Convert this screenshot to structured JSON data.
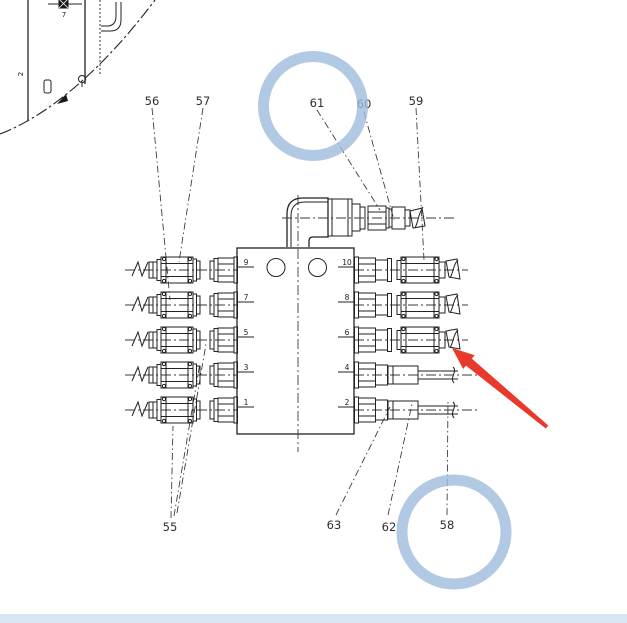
{
  "callouts": {
    "n55": "55",
    "n56": "56",
    "n57": "57",
    "n58": "58",
    "n59": "59",
    "n60": "60",
    "n61": "61",
    "n62": "62",
    "n63": "63"
  },
  "ports": {
    "left": [
      "9",
      "7",
      "5",
      "3",
      "1"
    ],
    "right": [
      "10",
      "8",
      "6",
      "4",
      "2"
    ]
  },
  "fragment": {
    "edge_mark": "2",
    "bolt_mark": "7"
  },
  "annotations": {
    "highlight_color": "#9dbbdc",
    "arrow_color": "#e8392b",
    "bar_color": "#d9e7f5"
  }
}
